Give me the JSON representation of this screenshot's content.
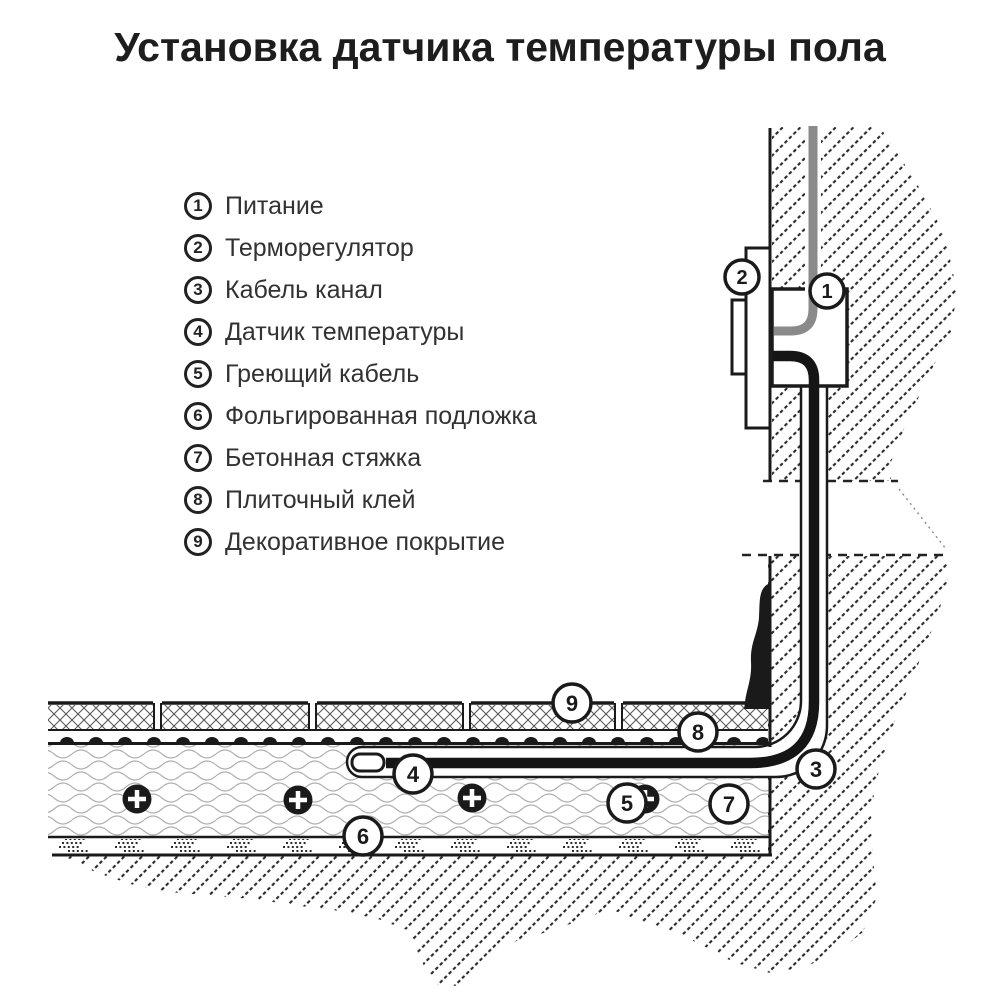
{
  "title": "Установка датчика температуры пола",
  "legend": {
    "items": [
      {
        "num": "1",
        "label": "Питание"
      },
      {
        "num": "2",
        "label": "Терморегулятор"
      },
      {
        "num": "3",
        "label": "Кабель канал"
      },
      {
        "num": "4",
        "label": "Датчик температуры"
      },
      {
        "num": "5",
        "label": "Греющий кабель"
      },
      {
        "num": "6",
        "label": "Фольгированная подложка"
      },
      {
        "num": "7",
        "label": "Бетонная стяжка"
      },
      {
        "num": "8",
        "label": "Плиточный клей"
      },
      {
        "num": "9",
        "label": "Декоративное покрытие"
      }
    ]
  },
  "callouts": {
    "c1": "1",
    "c2": "2",
    "c3": "3",
    "c4": "4",
    "c5": "5",
    "c6": "6",
    "c7": "7",
    "c8": "8",
    "c9": "9"
  },
  "colors": {
    "ink": "#1a1a1a",
    "hatch": "#2a2a2a",
    "cable_gray": "#8a8a8a",
    "background": "#ffffff"
  }
}
